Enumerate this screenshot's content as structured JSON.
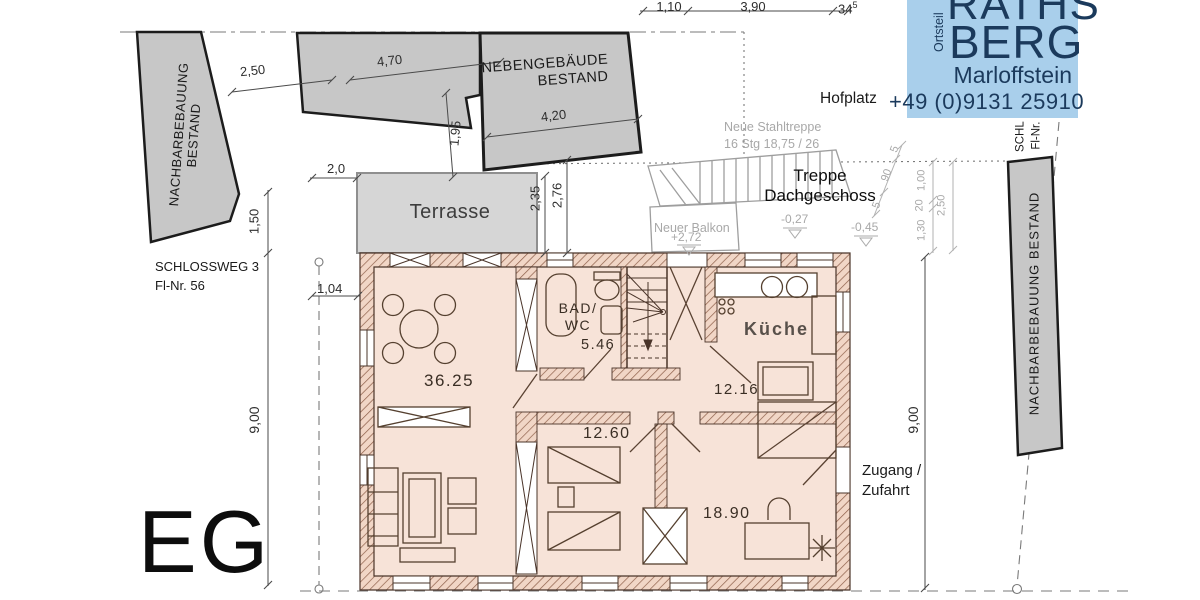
{
  "colors": {
    "logo_bg": "#a9cfeb",
    "logo_text": "#1b3a5c",
    "site_gray": "#c7c7c7",
    "plan_fill": "#f7e3d8",
    "wall_hatch": "#8d5f49"
  },
  "logo": {
    "line1": "RATHS",
    "line2": "BERG",
    "district_label": "Ortsteil",
    "town": "Marloffstein",
    "phone": "+49 (0)9131 25910"
  },
  "site": {
    "neighbor_left_1": "NACHBARBEBAUUNG",
    "neighbor_left_2": "BESTAND",
    "neighbor_right": "NACHBARBEBAUUNG  BESTAND",
    "outbuilding_1": "NEBENGEBÄUDE",
    "outbuilding_2": "BESTAND",
    "hofplatz": "Hofplatz",
    "street": "SCHLOSSWEG 3",
    "parcel": "Fl-Nr. 56",
    "right_street": "SCHL",
    "right_parcel": "Fl-Nr.",
    "access_1": "Zugang /",
    "access_2": "Zufahrt",
    "terrace": "Terrasse",
    "balcony": "Neuer Balkon",
    "balcony_level": "+2,72",
    "steel_stair_1": "Neue Stahltreppe",
    "steel_stair_2": "16 Stg 18,75 / 26",
    "attic_stair_1": "Treppe",
    "attic_stair_2": "Dachgeschoss",
    "level_a": "-0,27",
    "level_b": "-0,45"
  },
  "plan": {
    "floor": "EG",
    "room_living_area": "36.25",
    "bath_1": "BAD/",
    "bath_2": "WC",
    "bath_area": "5.46",
    "kitchen": "Küche",
    "kitchen_area": "12.16",
    "room1_area": "12.60",
    "room2_area": "18.90"
  },
  "dims": {
    "top_1": "1,10",
    "top_2": "3,90",
    "top_3": "34",
    "top_3_sup": "5",
    "left_gap": "2,50",
    "out_a": "4,70",
    "out_b": "4,20",
    "out_c": "1,95",
    "terrace_w": "2,0",
    "terrace_d1": "2,35",
    "terrace_d2": "2,76",
    "left_1": "1,50",
    "left_main": "9,00",
    "left_2": "1,04",
    "right_main": "9,00",
    "s1": "5",
    "s2": "90",
    "s3": "5",
    "s4": "1,00",
    "s5": "20",
    "s6": "1,30",
    "s7": "2,50"
  }
}
